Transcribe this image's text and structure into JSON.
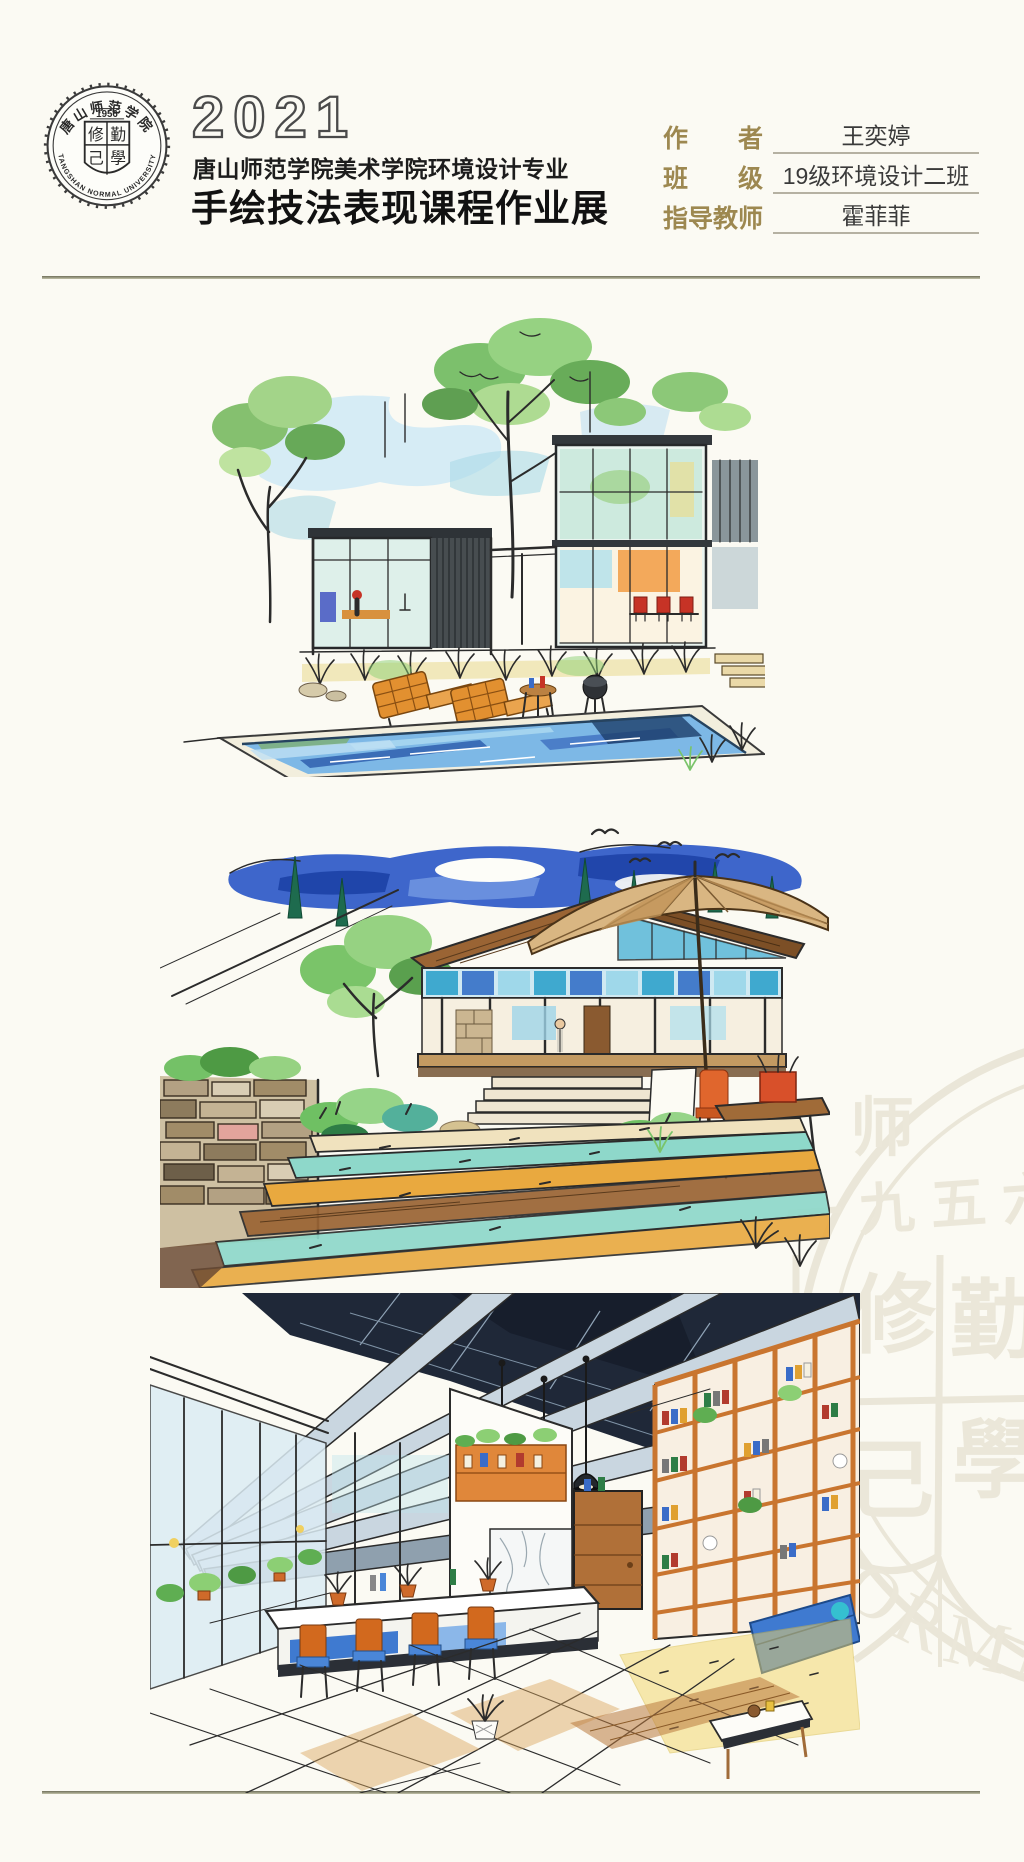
{
  "poster": {
    "background": "#fbfaf3",
    "divider_color": "#6f6f5a",
    "accent_label_color": "#9d8850"
  },
  "header": {
    "year": "2021",
    "department": "唐山师范学院美术学院环境设计专业",
    "title": "手绘技法表现课程作业展",
    "logo": {
      "founded": "1956",
      "school_name_cn": "唐山师范学院",
      "school_name_en": "TANGSHAN NORMAL UNIVERSITY",
      "motto_chars": [
        "修",
        "勤",
        "己",
        "學"
      ]
    },
    "info_rows": [
      {
        "label": "作　　者",
        "value": "王奕婷"
      },
      {
        "label": "班　　级",
        "value": "19级环境设计二班"
      },
      {
        "label": "指导教师",
        "value": "霍菲菲"
      }
    ]
  },
  "artworks": [
    {
      "alt": "集装箱玻璃屋与庭院泳池景观 马克笔手绘效果图"
    },
    {
      "alt": "坡屋顶住宅与宽台阶庭院 马克笔手绘效果图"
    },
    {
      "alt": "书架咖啡吧室内空间 马克笔手绘效果图"
    }
  ],
  "watermark": {
    "school_cn_fragment": "师　范",
    "founded_cn": "一九五六",
    "name_en_fragment": "ORMA"
  }
}
